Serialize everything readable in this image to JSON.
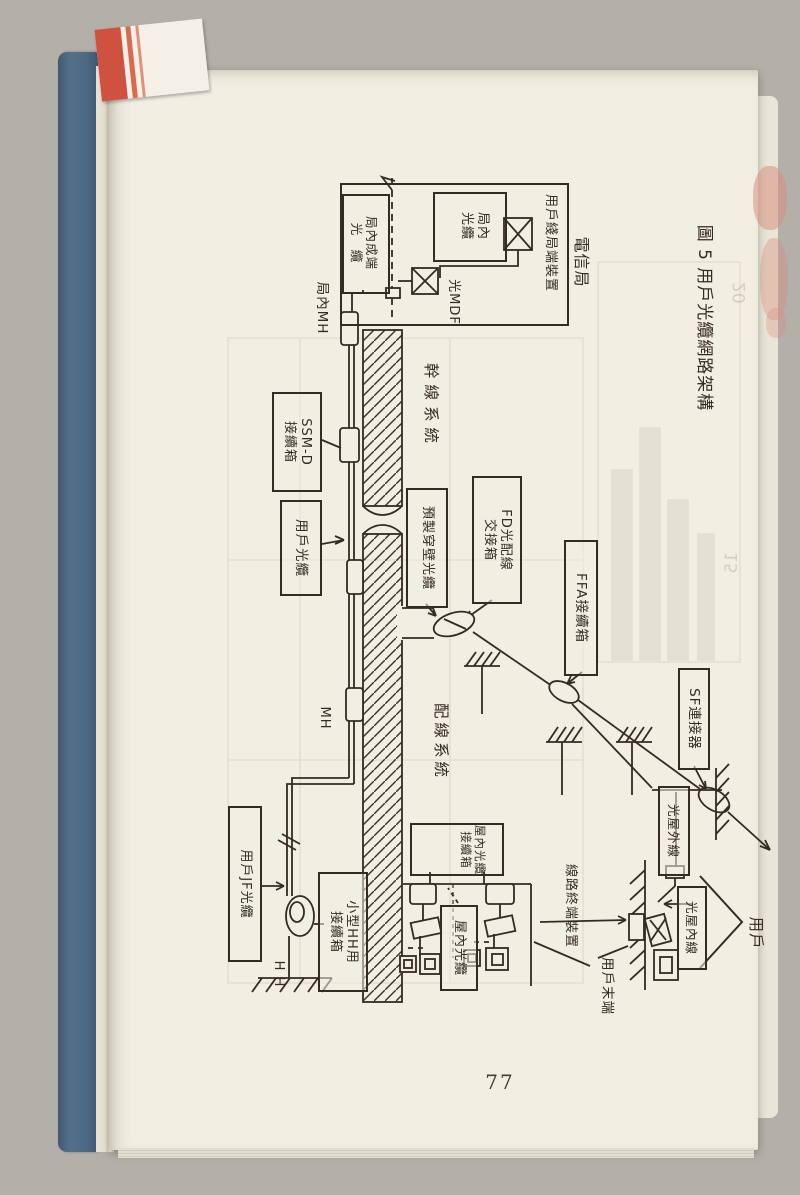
{
  "book": {
    "page_number": "77",
    "bookmark": "red-white bookmark tab",
    "spine_color": "#4d6a82",
    "page_color": "#f1eee2",
    "ink_color": "#342b22"
  },
  "figure": {
    "title": "圖 5  用戶光纜網路架構",
    "labels": {
      "telecom_office": "電信局",
      "office_terminal_device": "用戶綫局端裝置",
      "office_cable_l1": "局內",
      "office_cable_l2": "光纜",
      "office_term_cable_l1": "局內成端",
      "office_term_cable_l2": "光　纜",
      "optical_mdf": "光MDF",
      "office_mh": "局內MH",
      "trunk_system": "幹線系統",
      "ssm_box_l1": "SSM-D",
      "ssm_box_l2": "接續箱",
      "subscriber_cable": "用戶光纜",
      "prefab_wall_cable": "預製穿壁光纜",
      "fd_box_l1": "FD光配線",
      "fd_box_l2": "交接箱",
      "ffa_box": "FFA接續箱",
      "sf_connector": "SF連接器",
      "mh": "MH",
      "distribution_system": "配線系統",
      "jf_cable": "用戶JF光纜",
      "hh": "H H",
      "small_hh_box_l1": "小型HH用",
      "small_hh_box_l2": "接續箱",
      "indoor_splice_l1": "屋內光纜",
      "indoor_splice_l2": "接續箱",
      "indoor_cable": "屋內光纜",
      "line_terminal": "線路終端裝置",
      "outdoor_line": "光屋外線",
      "indoor_line": "光屋內線",
      "user": "用戶",
      "user_terminal": "用戶末端"
    }
  },
  "bleed_through": {
    "numbers": [
      "20",
      "15"
    ]
  }
}
